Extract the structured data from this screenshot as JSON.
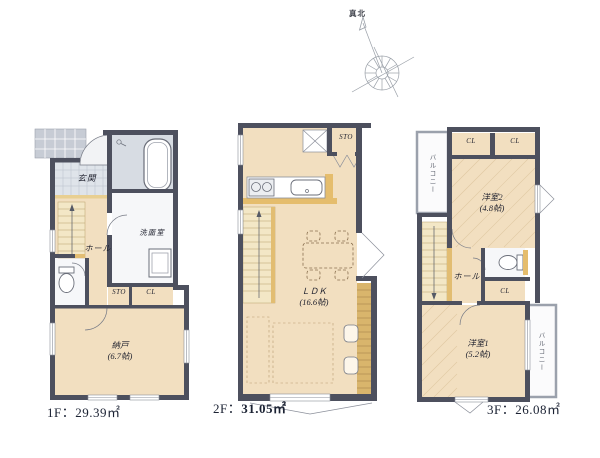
{
  "compass": {
    "north_label": "真北"
  },
  "floors": {
    "f1": {
      "caption_prefix": "1F：",
      "caption_area": "29.39㎡",
      "rooms": {
        "genkan": "玄関",
        "washroom": "洗面室",
        "hall": "ホール",
        "sto": "STO",
        "cl": "CL",
        "storage_name": "納戸",
        "storage_size": "(6.7帖)"
      }
    },
    "f2": {
      "caption_prefix": "2F：",
      "caption_area": "31.05㎡",
      "rooms": {
        "sto": "STO",
        "ldk_name": "ＬＤＫ",
        "ldk_size": "(16.6帖)"
      }
    },
    "f3": {
      "caption_prefix": "3F：",
      "caption_area": "26.08㎡",
      "rooms": {
        "cl_left": "CL",
        "cl_right": "CL",
        "bedroom2_name": "洋室2",
        "bedroom2_size": "(4.8帖)",
        "hall": "ホール",
        "cl_mid": "CL",
        "bedroom1_name": "洋室1",
        "bedroom1_size": "(5.2帖)",
        "balcony_upper": "バルコニー",
        "balcony_lower": "バルコニー"
      }
    }
  },
  "colors": {
    "wall": "#4d505e",
    "floor_cream": "#f2dfc0",
    "wood_accent": "#e2ba6e",
    "stairs_wood": "#f3e7c6",
    "tile_outdoor": "#c7ccd5",
    "tile_entry": "#dfe4ea",
    "bath_floor": "#d7dce3",
    "wet_floor": "#f6f7f9",
    "deck_wood": "#d9b56c",
    "balcony_wall": "#9ba1ac",
    "line_grey": "#8b8f9a",
    "text_dark": "#1d1f2c"
  }
}
